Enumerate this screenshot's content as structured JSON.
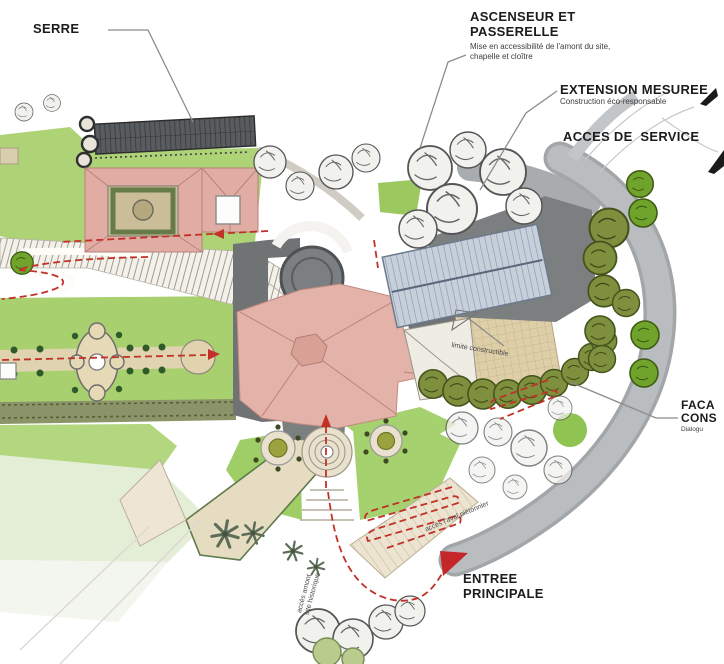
{
  "annotations": {
    "serre": {
      "label": "SERRE"
    },
    "ascenseur": {
      "title_line1": "ASCENSEUR ET",
      "title_line2": "PASSERELLE",
      "subtitle_line1": "Mise en accessibilité de l'amont du site,",
      "subtitle_line2": "chapelle et cloître"
    },
    "extension": {
      "title": "EXTENSION MESUREE",
      "subtitle": "Construction éco-responsable"
    },
    "acces_service": {
      "label": "ACCES DE  SERVICE"
    },
    "facade": {
      "title_line1": "FACA",
      "title_line2": "CONS",
      "subtitle": "Dialogu"
    },
    "entree": {
      "title_line1": "ENTREE",
      "title_line2": "PRINCIPALE"
    }
  },
  "plan_texts": {
    "limite_constructible": "limite constructible",
    "acces_amont_line1": "accès amont",
    "acces_amont_line2": "site historique",
    "acces_aval": "accès l'aval piétonnier"
  },
  "palette": {
    "lawn_green": "#a8d06e",
    "pale_lawn": "#e4eed6",
    "olive_tree": "#7e8f3d",
    "bright_tree": "#6fa32c",
    "pink_roof": "#e3b2a8",
    "dark_roof": "#6f7374",
    "metal_roof": "#c7d0da",
    "plaza_tan": "#decfa9",
    "road_gray": "#b4b8bb",
    "route_red": "#c23127",
    "entrance_marker_red": "#c4262a",
    "leader_gray": "#8c8c8c"
  }
}
